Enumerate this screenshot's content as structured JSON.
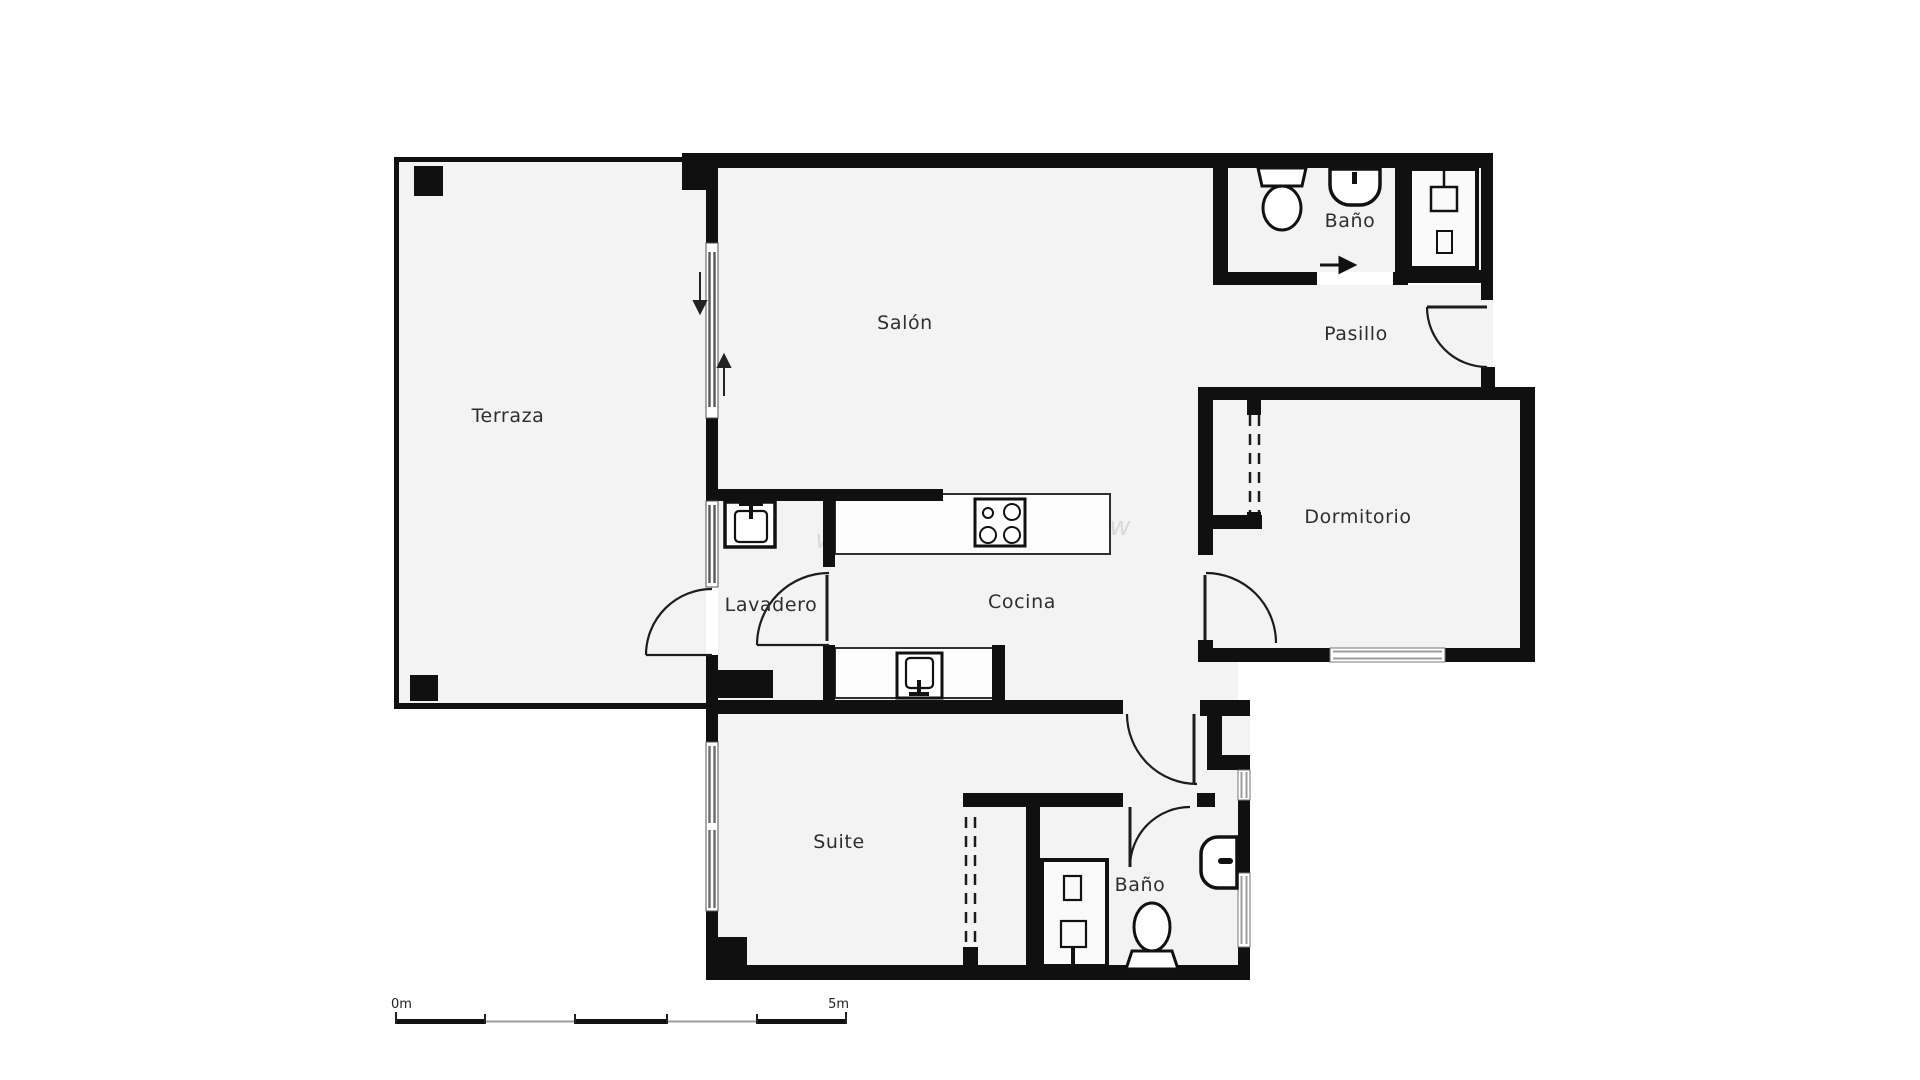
{
  "title": "Apartment floor plan",
  "rooms": [
    {
      "id": "terraza",
      "label": "Terraza"
    },
    {
      "id": "salon",
      "label": "Salón"
    },
    {
      "id": "bano_top",
      "label": "Baño"
    },
    {
      "id": "pasillo",
      "label": "Pasillo"
    },
    {
      "id": "dormitorio",
      "label": "Dormitorio"
    },
    {
      "id": "lavadero",
      "label": "Lavadero"
    },
    {
      "id": "cocina",
      "label": "Cocina"
    },
    {
      "id": "suite",
      "label": "Suite"
    },
    {
      "id": "bano_suite",
      "label": "Baño"
    }
  ],
  "fixtures": {
    "bano_top": [
      "toilet",
      "washbasin"
    ],
    "shower_room_top": [
      "shower-tray"
    ],
    "lavadero": [
      "washing-machine"
    ],
    "cocina": [
      "stove-4-burners",
      "kitchen-sink"
    ],
    "bano_suite": [
      "shower-tray",
      "toilet",
      "washbasin"
    ]
  },
  "icons": [
    "entry-arrow",
    "sliding-door-arrow-down",
    "sliding-door-arrow-up"
  ],
  "wardrobes": [
    "dormitorio-built-in",
    "suite-built-in"
  ],
  "scale_bar": {
    "start_label": "0m",
    "end_label": "5m"
  },
  "watermark": "w",
  "colors": {
    "wall": "#101010",
    "floor": "#f3f3f3",
    "background": "#ffffff",
    "glass": "#5f5f5f",
    "window_light": "#9c9c9c",
    "label": "#2e2e2e",
    "counter_line": "#2f2f2f"
  }
}
